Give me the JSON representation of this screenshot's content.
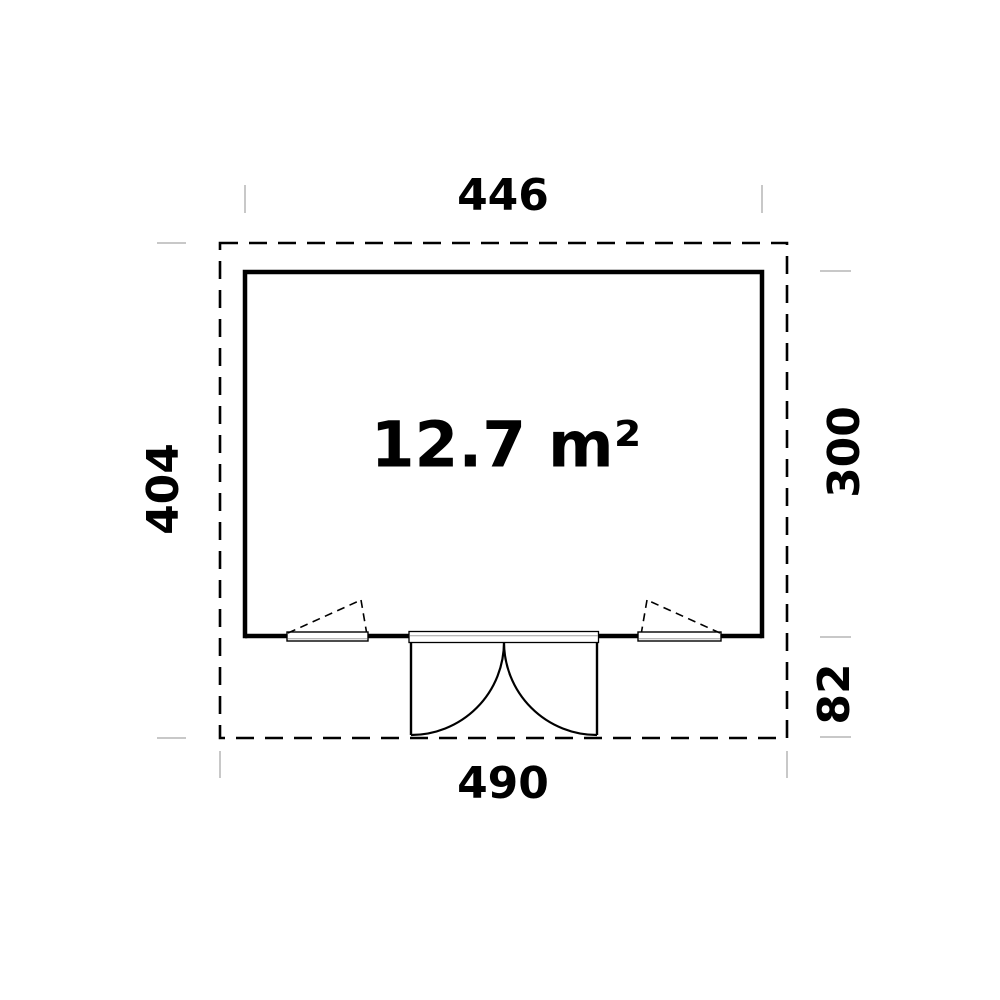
{
  "diagram": {
    "type": "floor-plan",
    "area_label": "12.7 m²",
    "dimensions": {
      "width_top": "446",
      "height_left": "404",
      "height_right": "300",
      "depth_right_lower": "82",
      "width_bottom": "490"
    },
    "colors": {
      "line": "#000000",
      "extension_tick": "#c8c8c8",
      "background": "#ffffff"
    }
  }
}
